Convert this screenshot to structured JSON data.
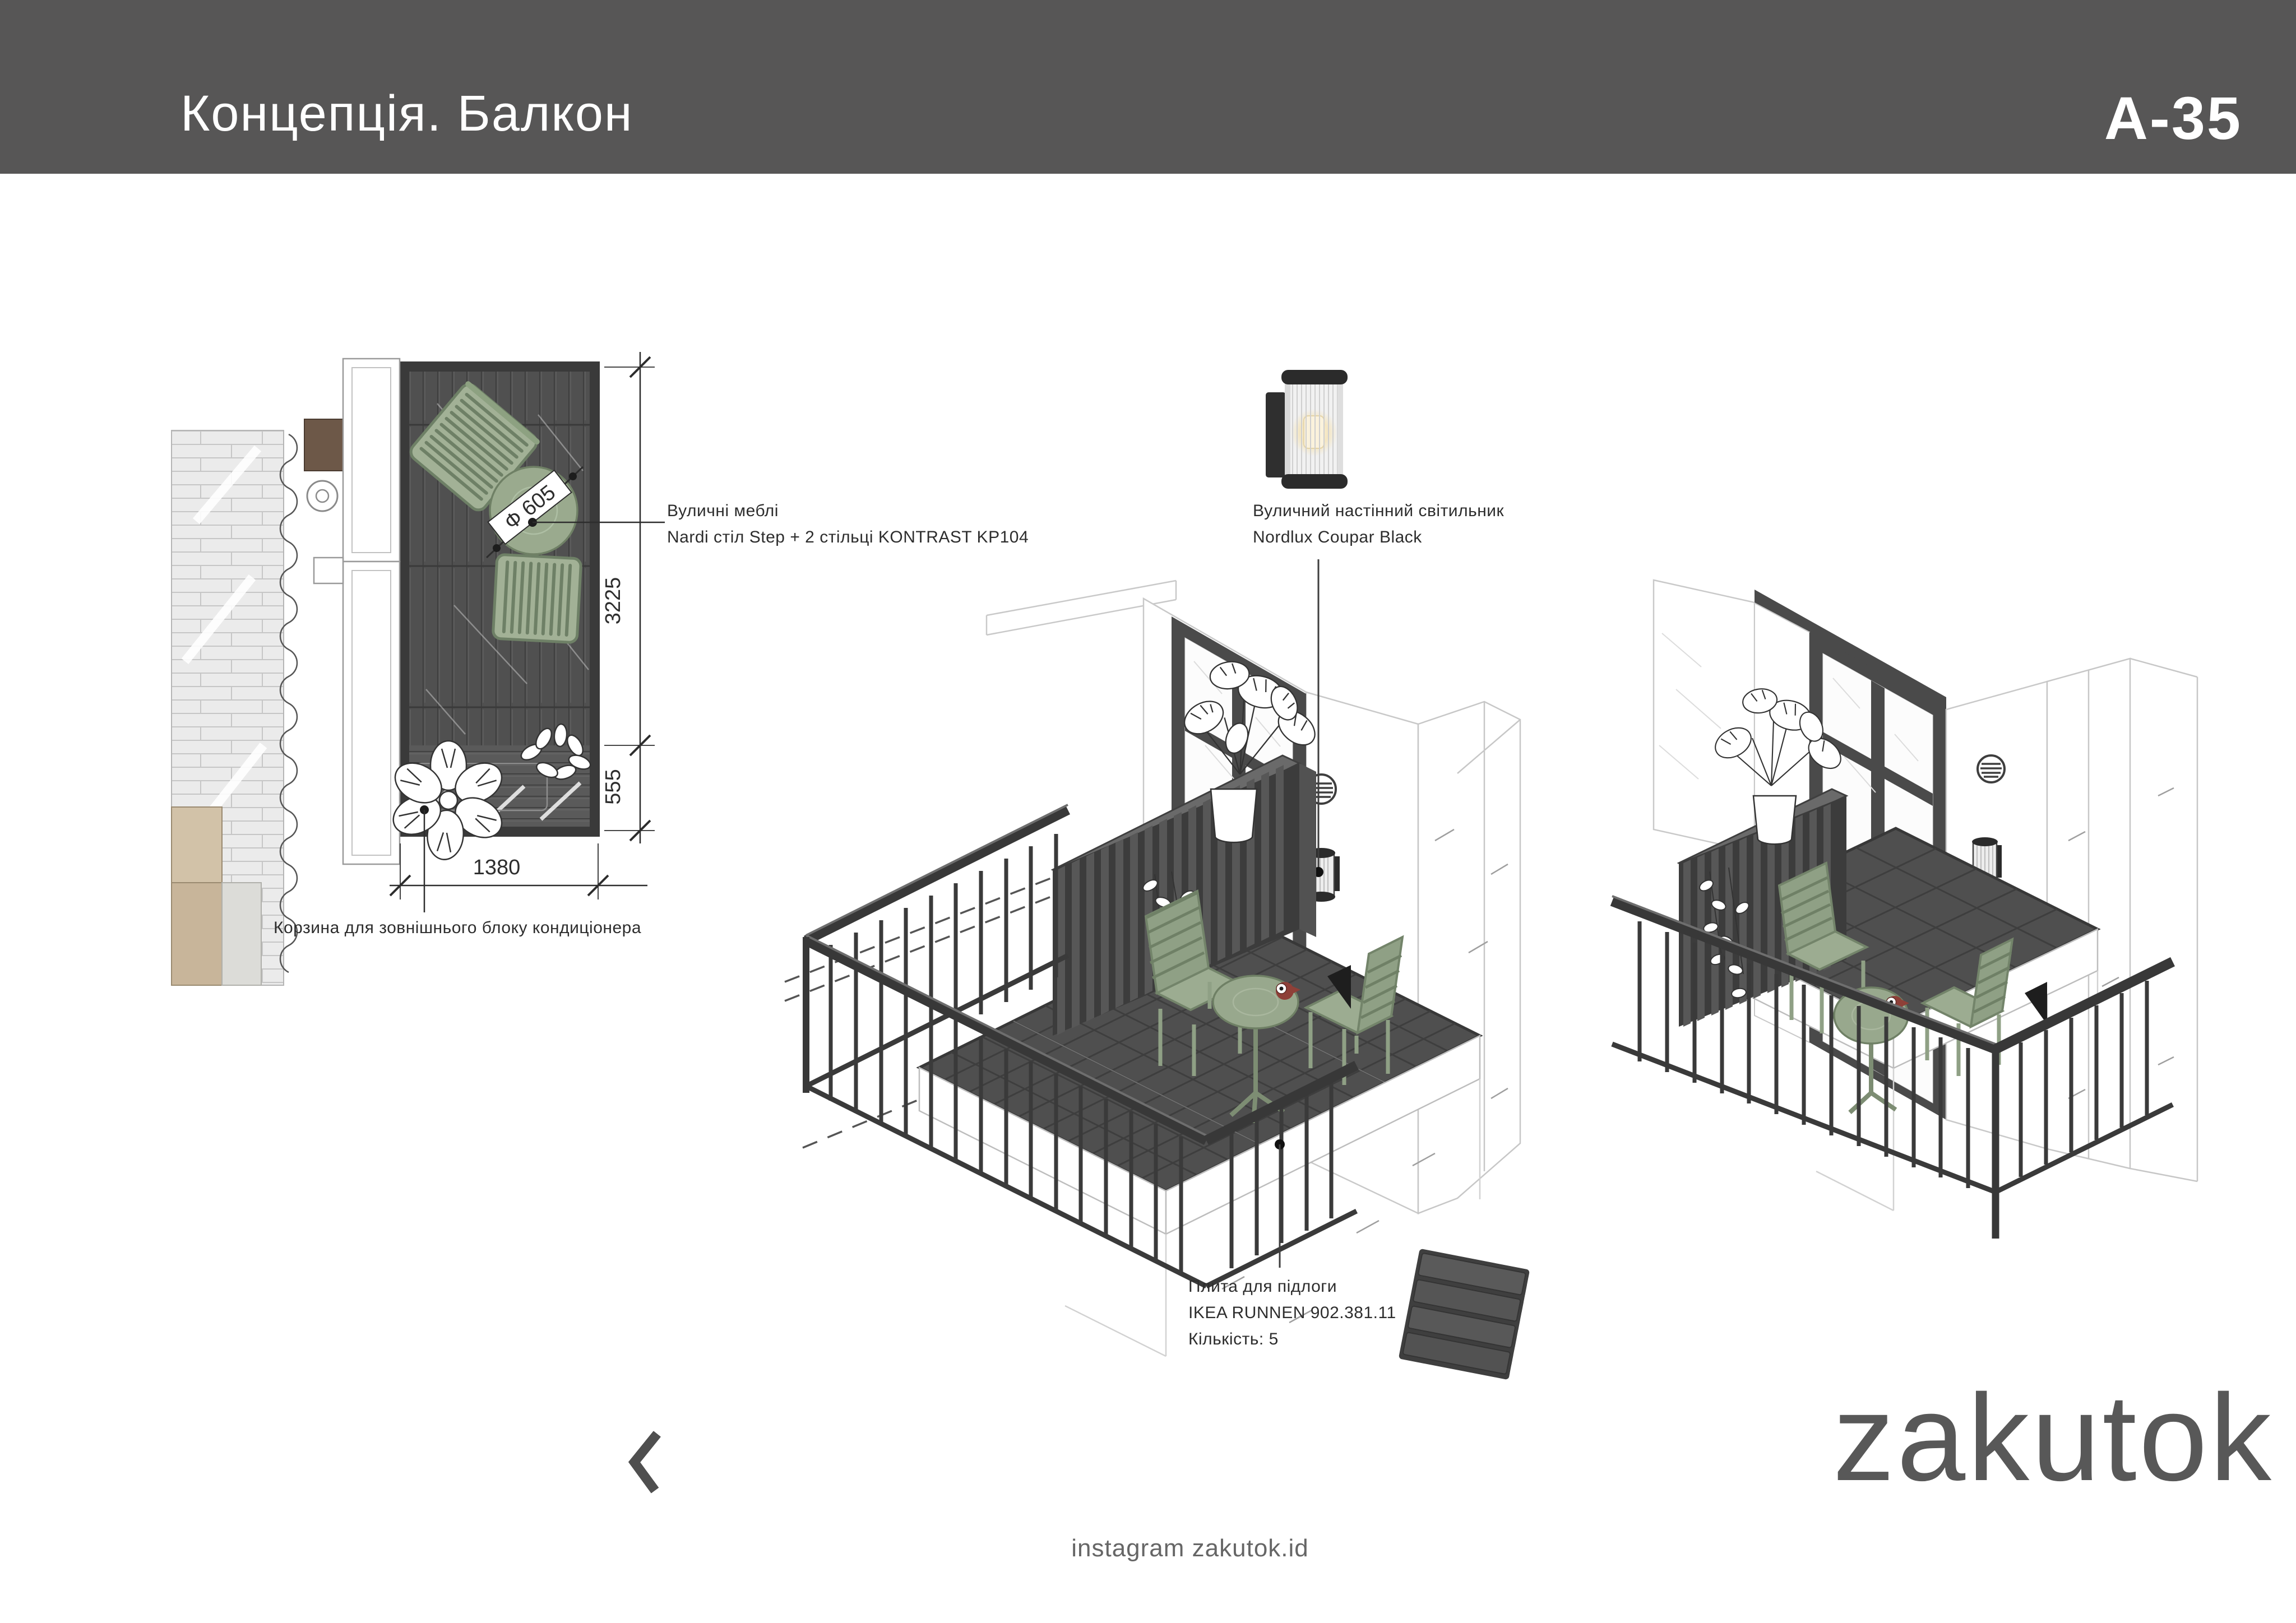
{
  "header": {
    "title": "Концепція. Балкон",
    "sheet_code": "A-35",
    "bar_color": "#575656",
    "text_color": "#ffffff"
  },
  "plan": {
    "dimensions": {
      "depth_total": "3225",
      "basket_depth": "555",
      "width": "1380",
      "table_diameter_label": "Ф 605"
    },
    "callouts": {
      "furniture_line1": "Вуличні меблі",
      "furniture_line2": "Nardi стіл Step + 2 стільці KONTRAST KP104",
      "ac_basket": "Корзина для зовнішнього блоку кондиціонера"
    }
  },
  "callouts": {
    "wall_lamp_line1": "Вуличний настінний світильник",
    "wall_lamp_line2": "Nordlux Coupar Black",
    "floor_tile_line1": "Плита для підлоги",
    "floor_tile_line2": "IKEA RUNNEN 902.381.11",
    "floor_tile_line3": "Кількість: 5"
  },
  "footer": {
    "brand": "zakutok",
    "instagram": "instagram zakutok.id",
    "chevron_count": 10
  },
  "colors": {
    "header_gray": "#575656",
    "sage_green": "#9caf92",
    "railing_black": "#3a3a3a",
    "deck_gray": "#505050",
    "ochre_wall": "#c8b59a",
    "red_accent": "#8e4038",
    "logo_gray": "#585858"
  }
}
